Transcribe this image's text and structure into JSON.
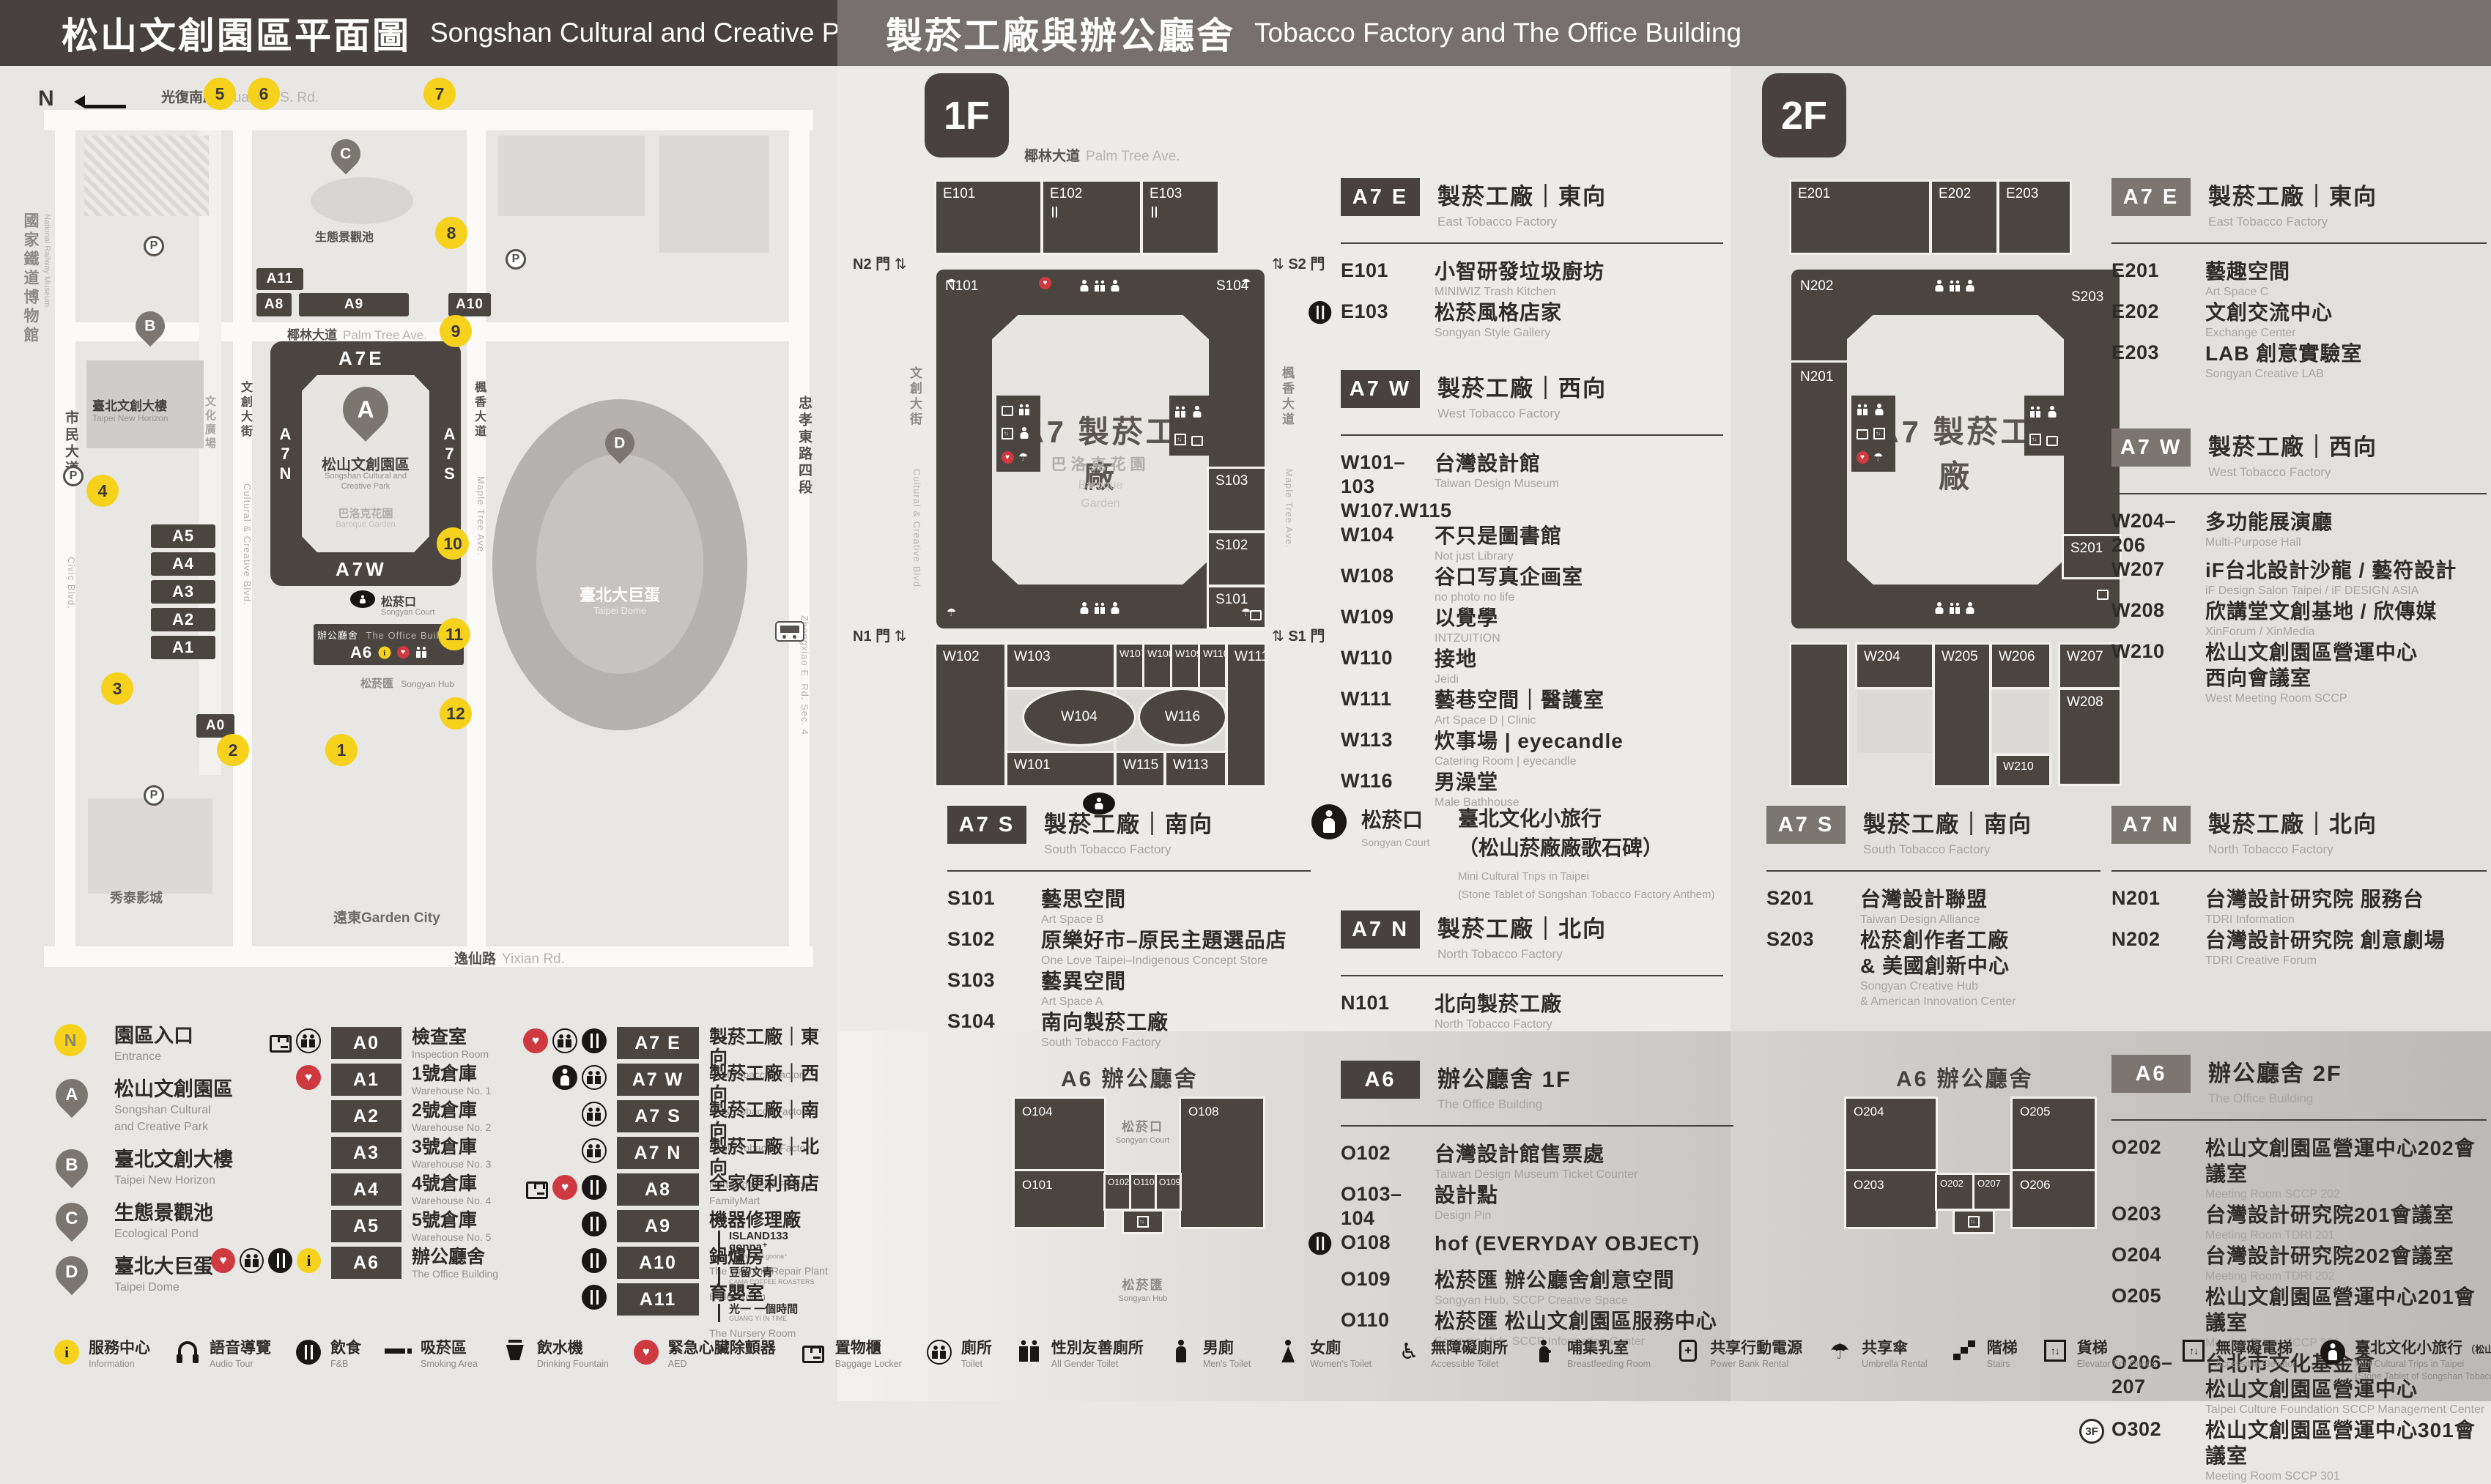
{
  "header": {
    "left_zh": "松山文創園區平面圖",
    "left_en": "Songshan Cultural and Creative Park Floor Plan",
    "right_zh": "製菸工廠與辦公廳舍",
    "right_en": "Tobacco Factory and The Office Building"
  },
  "map": {
    "compass": "N",
    "museum_zh": "國家鐵道博物館",
    "museum_en": "National Railway Museum",
    "streets": {
      "top_zh": "光復南路",
      "top_en": "Guangfu S. Rd.",
      "left_zh": "市民大道",
      "left_en": "Civic Blvd.",
      "right_zh": "忠孝東路四段",
      "right_en": "Zhongxiao E. Rd. Sec. 4",
      "bottom_zh": "逸仙路",
      "bottom_en": "Yixian Rd.",
      "palm_zh": "椰林大道",
      "palm_en": "Palm Tree Ave.",
      "cultural_zh": "文創大街",
      "cultural_en": "Cultural & Creative Blvd.",
      "maple_zh": "楓香大道",
      "maple_en": "Maple Tree Ave.",
      "plaza_zh": "文化廣場",
      "plaza_en": "Cultural Plaza"
    },
    "blocks": {
      "a11": "A11",
      "a8": "A8",
      "a9": "A9",
      "a10": "A10",
      "a5": "A5",
      "a4": "A4",
      "a3": "A3",
      "a2": "A2",
      "a1": "A1",
      "a0": "A0",
      "a6": "A6"
    },
    "ring": {
      "top": "A7E",
      "left": "A7N",
      "right": "A7S",
      "bottom": "A7W"
    },
    "pins": {
      "a": "A",
      "b": "B",
      "c": "C",
      "d": "D"
    },
    "labels": {
      "park_zh": "松山文創園區",
      "park_en1": "Songshan Cultural and",
      "park_en2": "Creative Park",
      "garden_zh": "巴洛克花園",
      "garden_en": "Baroque Garden",
      "court_zh": "松菸口",
      "court_en": "Songyan Court",
      "office_zh": "辦公廳舍",
      "office_en": "The Office Building",
      "hub_zh": "松菸匯",
      "hub_en": "Songyan Hub",
      "pond_zh": "生態景觀池",
      "horizon_zh": "臺北文創大樓",
      "horizon_en": "Taipei New Horizon",
      "dome_zh": "臺北大巨蛋",
      "dome_en": "Taipei Dome",
      "garden_city": "遠東Garden City",
      "cinema": "秀泰影城",
      "parking": "P"
    },
    "entrances": [
      "5",
      "6",
      "7",
      "8",
      "9",
      "10",
      "11",
      "12",
      "4",
      "3",
      "2",
      "1"
    ]
  },
  "legend": {
    "points": [
      {
        "marker": "N",
        "kind": "entrm",
        "zh": "園區入口",
        "en": "Entrance"
      },
      {
        "marker": "A",
        "kind": "pinm",
        "zh": "松山文創園區",
        "en": "Songshan Cultural",
        "en2": "and Creative Park"
      },
      {
        "marker": "B",
        "kind": "pinm",
        "zh": "臺北文創大樓",
        "en": "Taipei New Horizon"
      },
      {
        "marker": "C",
        "kind": "pinm",
        "zh": "生態景觀池",
        "en": "Ecological Pond"
      },
      {
        "marker": "D",
        "kind": "pinm",
        "zh": "臺北大巨蛋",
        "en": "Taipei Dome"
      }
    ],
    "col_a": [
      {
        "code": "A0",
        "zh": "檢查室",
        "en": "Inspection Room",
        "i1": "locker",
        "i2": "toilet"
      },
      {
        "code": "A1",
        "zh": "1號倉庫",
        "en": "Warehouse No. 1",
        "i1": "aed"
      },
      {
        "code": "A2",
        "zh": "2號倉庫",
        "en": "Warehouse No. 2"
      },
      {
        "code": "A3",
        "zh": "3號倉庫",
        "en": "Warehouse No. 3"
      },
      {
        "code": "A4",
        "zh": "4號倉庫",
        "en": "Warehouse No. 4"
      },
      {
        "code": "A5",
        "zh": "5號倉庫",
        "en": "Warehouse No. 5"
      },
      {
        "code": "A6",
        "zh": "辦公廳舍",
        "en": "The Office Building",
        "i1": "aed",
        "i2": "toilet",
        "i3": "fnb",
        "i4": "info"
      }
    ],
    "col_b": [
      {
        "code": "A7 E",
        "zh": "製菸工廠｜東向",
        "en": "East Tobacco Factory",
        "i1": "aed",
        "i2": "toilet",
        "i3": "fnb"
      },
      {
        "code": "A7 W",
        "zh": "製菸工廠｜西向",
        "en": "West Tobacco Factory",
        "i1": "trips",
        "i2": "toilet"
      },
      {
        "code": "A7 S",
        "zh": "製菸工廠｜南向",
        "en": "South Tobacco Factory",
        "i1": "toilet"
      },
      {
        "code": "A7 N",
        "zh": "製菸工廠｜北向",
        "en": "North Tobacco Factory",
        "i1": "toilet"
      },
      {
        "code": "A8",
        "zh": "全家便利商店",
        "en": "FamilyMart",
        "i1": "locker",
        "i2": "aed",
        "i3": "fnb"
      },
      {
        "code": "A9",
        "zh": "機器修理廠",
        "en": "The Machine Repair Plant",
        "sub_zh": "ISLAND133 gonna⁺",
        "sub_en": "ISLAND133 gonna⁺",
        "i1": "fnb"
      },
      {
        "code": "A10",
        "zh": "鍋爐房",
        "en": "Boiler Room",
        "sub_zh": "豆留文青",
        "sub_en": "CAMA COFFEE ROASTERS",
        "i1": "fnb"
      },
      {
        "code": "A11",
        "zh": "育嬰室",
        "en": "The Nursery Room",
        "sub_zh": "光一 一個時間",
        "sub_en": "GUANG YI IN TIME",
        "i1": "fnb"
      }
    ]
  },
  "f1": {
    "floor": "1F",
    "plan": {
      "street_top_zh": "椰林大道",
      "street_top_en": "Palm Tree Ave.",
      "street_left_zh": "文創大街",
      "street_left_en": "Cultural & Creative Blvd.",
      "street_right_zh": "楓香大道",
      "street_right_en": "Maple Tree Ave.",
      "gates": {
        "n2": "N2 門",
        "s2": "S2 門",
        "n1": "N1 門",
        "s1": "S1 門"
      },
      "center": "A7 製菸工廠",
      "garden_zh": "巴洛克花園",
      "garden_en1": "Baroque",
      "garden_en2": "Garden",
      "rooms": {
        "e101": "E101",
        "e102": "E102",
        "e103": "E103",
        "n101": "N101",
        "s101": "S101",
        "s102": "S102",
        "s103": "S103",
        "s104": "S104",
        "w101": "W101",
        "w102": "W102",
        "w103": "W103",
        "w104": "W104",
        "w107": "W107",
        "w108": "W108",
        "w109": "W109",
        "w110": "W110",
        "w111": "W111",
        "w113": "W113",
        "w115": "W115",
        "w116": "W116"
      }
    },
    "sections": {
      "a7e": {
        "badge": "A7 E",
        "zh": "製菸工廠｜東向",
        "en": "East Tobacco Factory",
        "items": [
          {
            "code": "E101",
            "zh": "小智研發垃圾廚坊",
            "en": "MINIWIZ Trash Kitchen"
          },
          {
            "icon": "fnb",
            "code": "E103",
            "zh": "松菸風格店家",
            "en": "Songyan Style Gallery"
          }
        ]
      },
      "a7w": {
        "badge": "A7 W",
        "zh": "製菸工廠｜西向",
        "en": "West Tobacco Factory",
        "items": [
          {
            "code": "W101–103",
            "code2": "W107.W115",
            "zh": "台灣設計館",
            "en": "Taiwan Design Museum"
          },
          {
            "code": "W104",
            "zh": "不只是圖書館",
            "en": "Not just Library"
          },
          {
            "code": "W108",
            "zh": "谷口写真企画室",
            "en": "no photo no life"
          },
          {
            "code": "W109",
            "zh": "以覺學",
            "en": "INTZUITION"
          },
          {
            "code": "W110",
            "zh": "接地",
            "en": "Jeidi"
          },
          {
            "code": "W111",
            "zh": "藝巷空間｜醫護室",
            "en": "Art Space D | Clinic"
          },
          {
            "code": "W113",
            "zh": "炊事場 | eyecandle",
            "en": "Catering Room | eyecandle"
          },
          {
            "code": "W116",
            "zh": "男澡堂",
            "en": "Male Bathhouse"
          }
        ]
      },
      "a7s": {
        "badge": "A7 S",
        "zh": "製菸工廠｜南向",
        "en": "South Tobacco Factory",
        "items": [
          {
            "code": "S101",
            "zh": "藝思空間",
            "en": "Art Space B"
          },
          {
            "code": "S102",
            "zh": "原樂好市–原民主題選品店",
            "en": "One Love Taipei–Indigenous Concept Store"
          },
          {
            "code": "S103",
            "zh": "藝異空間",
            "en": "Art Space A"
          },
          {
            "code": "S104",
            "zh": "南向製菸工廠",
            "en": "South Tobacco Factory"
          }
        ]
      },
      "a7n": {
        "badge": "A7 N",
        "zh": "製菸工廠｜北向",
        "en": "North Tobacco Factory",
        "items": [
          {
            "code": "N101",
            "zh": "北向製菸工廠",
            "en": "North Tobacco Factory"
          }
        ]
      },
      "a6": {
        "badge": "A6",
        "zh": "辦公廳舍 1F",
        "en": "The Office Building",
        "items": [
          {
            "code": "O102",
            "zh": "台灣設計館售票處",
            "en": "Taiwan Design Museum Ticket Counter"
          },
          {
            "code": "O103–104",
            "zh": "設計點",
            "en": "Design Pin"
          },
          {
            "icon": "fnb",
            "code": "O108",
            "zh": "hof (EVERYDAY OBJECT)"
          },
          {
            "code": "O109",
            "zh": "松菸匯 辦公廳舍創意空間",
            "en": "Songyan Hub, SCCP Creative Space"
          },
          {
            "code": "O110",
            "zh": "松菸匯 松山文創園區服務中心",
            "en": "Songyan Hub, SCCP Information Center"
          }
        ]
      }
    },
    "songyan": {
      "zh": "松菸口",
      "en": "Songyan Court",
      "t_zh": "臺北文化小旅行",
      "t_zh2": "（松山菸廠廠歌石碑）",
      "t_en": "Mini Cultural Trips in Taipei",
      "t_en2": "(Stone Tablet of Songshan Tobacco Factory Anthem)"
    },
    "a6plan": {
      "title": "A6 辦公廳舍",
      "court_zh": "松菸口",
      "court_en": "Songyan Court",
      "hub_zh": "松菸匯",
      "hub_en": "Songyan Hub",
      "rooms": {
        "o101": "O101",
        "o102": "O102",
        "o104": "O104",
        "o108": "O108",
        "o109": "O109",
        "o110": "O110"
      }
    }
  },
  "f2": {
    "floor": "2F",
    "plan": {
      "center": "A7 製菸工廠",
      "rooms": {
        "e201": "E201",
        "e202": "E202",
        "e203": "E203",
        "n201": "N201",
        "n202": "N202",
        "s201": "S201",
        "s203": "S203",
        "w204": "W204",
        "w205": "W205",
        "w206": "W206",
        "w207": "W207",
        "w208": "W208",
        "w210": "W210"
      }
    },
    "sections": {
      "a7e": {
        "badge": "A7 E",
        "zh": "製菸工廠｜東向",
        "en": "East Tobacco Factory",
        "items": [
          {
            "code": "E201",
            "zh": "藝趣空間",
            "en": "Art Space C"
          },
          {
            "code": "E202",
            "zh": "文創交流中心",
            "en": "Exchange Center"
          },
          {
            "code": "E203",
            "zh": "LAB 創意實驗室",
            "en": "Songyan Creative LAB"
          }
        ]
      },
      "a7w": {
        "badge": "A7 W",
        "zh": "製菸工廠｜西向",
        "en": "West Tobacco Factory",
        "items": [
          {
            "code": "W204–206",
            "zh": "多功能展演廳",
            "en": "Multi-Purpose Hall"
          },
          {
            "code": "W207",
            "zh": "iF台北設計沙龍 / 藝符設計",
            "en": "iF Design Salon Taipei / iF DESIGN ASIA"
          },
          {
            "code": "W208",
            "zh": "欣講堂文創基地 / 欣傳媒",
            "en": "XinForum / XinMedia"
          },
          {
            "code": "W210",
            "zh": "松山文創園區營運中心",
            "zh2": "西向會議室",
            "en": "West Meeting Room SCCP"
          }
        ]
      },
      "a7s": {
        "badge": "A7 S",
        "zh": "製菸工廠｜南向",
        "en": "South Tobacco Factory",
        "items": [
          {
            "code": "S201",
            "zh": "台灣設計聯盟",
            "en": "Taiwan Design Alliance"
          },
          {
            "code": "S203",
            "zh": "松菸創作者工廠",
            "zh2": "& 美國創新中心",
            "en": "Songyan Creative Hub",
            "en2": "& American Innovation Center"
          }
        ]
      },
      "a7n": {
        "badge": "A7 N",
        "zh": "製菸工廠｜北向",
        "en": "North Tobacco Factory",
        "items": [
          {
            "code": "N201",
            "zh": "台灣設計研究院 服務台",
            "en": "TDRI Information"
          },
          {
            "code": "N202",
            "zh": "台灣設計研究院 創意劇場",
            "en": "TDRI Creative Forum"
          }
        ]
      },
      "a6": {
        "badge": "A6",
        "zh": "辦公廳舍 2F",
        "en": "The Office Building",
        "items": [
          {
            "code": "O202",
            "zh": "松山文創園區營運中心202會議室",
            "en": "Meeting Room SCCP 202"
          },
          {
            "code": "O203",
            "zh": "台灣設計研究院201會議室",
            "en": "Meeting Room TDRI 201"
          },
          {
            "code": "O204",
            "zh": "台灣設計研究院202會議室",
            "en": "Meeting Room TDRI 202"
          },
          {
            "code": "O205",
            "zh": "松山文創園區營運中心201會議室",
            "en": "Meeting Room SCCP 201"
          },
          {
            "code": "O206–207",
            "zh": "台北市文化基金會",
            "zh2": "松山文創園區營運中心",
            "en": "Taipei Culture Foundation SCCP Management Center"
          },
          {
            "pre": "3F",
            "code": "O302",
            "zh": "松山文創園區營運中心301會議室",
            "en": "Meeting Room SCCP 301"
          }
        ]
      }
    },
    "a6plan": {
      "title": "A6 辦公廳舍",
      "rooms": {
        "o202": "O202",
        "o203": "O203",
        "o204": "O204",
        "o205": "O205",
        "o206": "O206",
        "o207": "O207"
      }
    }
  },
  "footer": {
    "items": [
      {
        "icon": "info",
        "zh": "服務中心",
        "en": "Information"
      },
      {
        "icon": "audio",
        "zh": "語音導覽",
        "en": "Audio Tour"
      },
      {
        "icon": "fnb",
        "zh": "飲食",
        "en": "F&B"
      },
      {
        "icon": "smoke",
        "zh": "吸菸區",
        "en": "Smoking Area"
      },
      {
        "icon": "cup",
        "zh": "飲水機",
        "en": "Drinking Fountain"
      },
      {
        "icon": "aed",
        "zh": "緊急心臟除顫器",
        "en": "AED"
      },
      {
        "icon": "locker",
        "zh": "置物櫃",
        "en": "Baggage Locker"
      },
      {
        "icon": "toilet",
        "zh": "廁所",
        "en": "Toilet"
      },
      {
        "icon": "allgender",
        "zh": "性別友善廁所",
        "en": "All Gender Toilet"
      },
      {
        "icon": "men",
        "zh": "男廁",
        "en": "Men's Toilet"
      },
      {
        "icon": "women",
        "zh": "女廁",
        "en": "Women's Toilet"
      },
      {
        "icon": "accessible",
        "zh": "無障礙廁所",
        "en": "Accessible Toilet"
      },
      {
        "icon": "nursing",
        "zh": "哺集乳室",
        "en": "Breastfeeding Room"
      },
      {
        "icon": "power",
        "zh": "共享行動電源",
        "en": "Power Bank Rental"
      },
      {
        "icon": "umbrella",
        "zh": "共享傘",
        "en": "Umbrella Rental"
      },
      {
        "icon": "stairs",
        "zh": "階梯",
        "en": "Stairs"
      },
      {
        "icon": "gelev",
        "zh": "貨梯",
        "en": "Elevator For Goods"
      },
      {
        "icon": "aelev",
        "zh": "無障礙電梯",
        "en": "Accessible Elevator"
      },
      {
        "icon": "trips",
        "zh": "臺北文化小旅行",
        "zh2": "（松山菸廠廠歌石碑）",
        "en": "Mini Cultural Trips in Taipei",
        "en2": "(Stone Tablet of Songshan Tobacco Factory Anthem)"
      }
    ]
  }
}
